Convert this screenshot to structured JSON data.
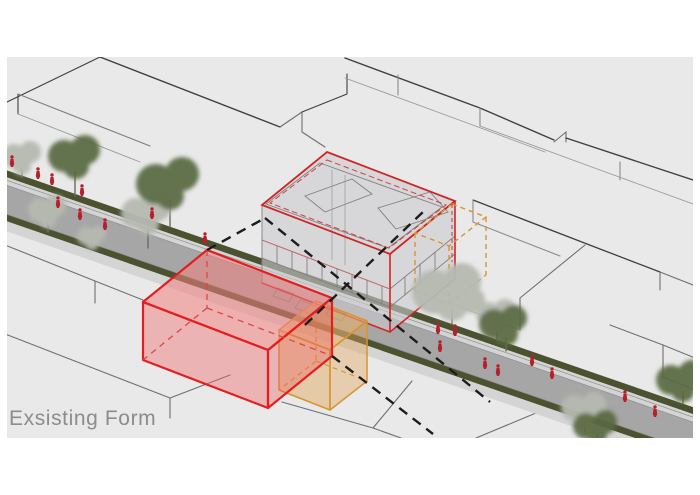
{
  "caption": {
    "text": "Exsisting Form",
    "color": "#8c8c8c"
  },
  "scene": {
    "type": "architectural-axonometric-street-diagram",
    "page_background": "#ffffff",
    "ground_color": "#e9e9e9",
    "block_line_color": "#3f3f3f",
    "street": {
      "road_color": "#a6a6a6",
      "hedge_color": "#4a5230",
      "sidewalk_color": "#d4d4d4",
      "curb_color": "#8f8f8f"
    },
    "massing": {
      "existing_form_box": {
        "stroke": "#e31e1e",
        "fill_top": "rgba(243,128,128,0.55)"
      },
      "extension_box": {
        "stroke": "#d9932f",
        "fill_top": "rgba(231,177,108,0.6)"
      },
      "site_volume_outline": {
        "stroke": "#d9932f",
        "style": "dashed"
      },
      "building_outline": {
        "stroke": "#d02525"
      }
    },
    "vegetation": {
      "dark_tree_color": "#5a6a42",
      "pale_tree_color": "#b6bab0",
      "trunk_color": "#6b6b60"
    },
    "pedestrian_color": "#b5202a",
    "leader_line_color": "#1c1c1c"
  }
}
